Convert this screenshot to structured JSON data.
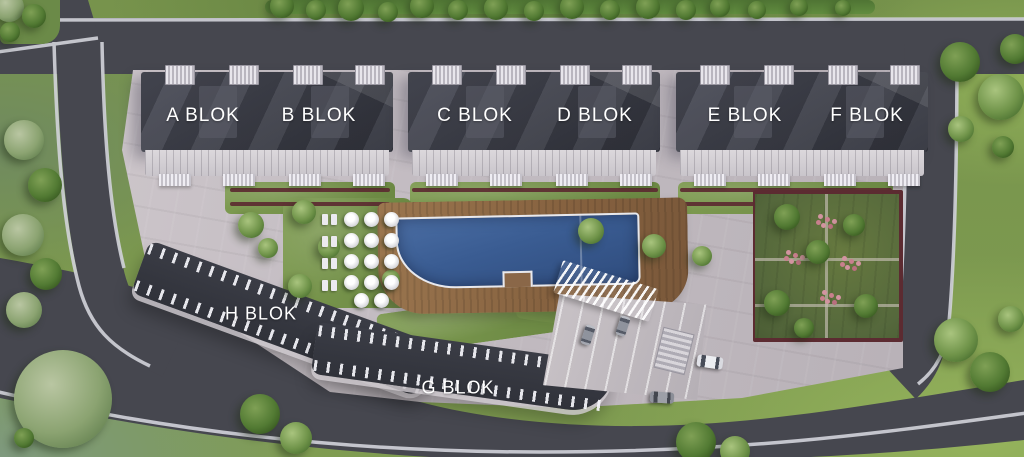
{
  "blocks": [
    {
      "id": "a",
      "label": "A BLOK"
    },
    {
      "id": "b",
      "label": "B BLOK"
    },
    {
      "id": "c",
      "label": "C BLOK"
    },
    {
      "id": "d",
      "label": "D BLOK"
    },
    {
      "id": "e",
      "label": "E BLOK"
    },
    {
      "id": "f",
      "label": "F BLOK"
    },
    {
      "id": "h",
      "label": "H BLOK"
    },
    {
      "id": "g",
      "label": "G BLOK"
    }
  ],
  "colors": {
    "roof": "#3d3f49",
    "road": "#46474f",
    "curb": "#d2d3da",
    "plaza": "#c3bcc2",
    "grass": "#77934c",
    "pool_water": "#3a5c92",
    "deck_wood": "#8a6748",
    "planter": "#5c2b31",
    "garden": "#55683c",
    "flowers": "#d294a0",
    "label_text": "#ffffff"
  }
}
